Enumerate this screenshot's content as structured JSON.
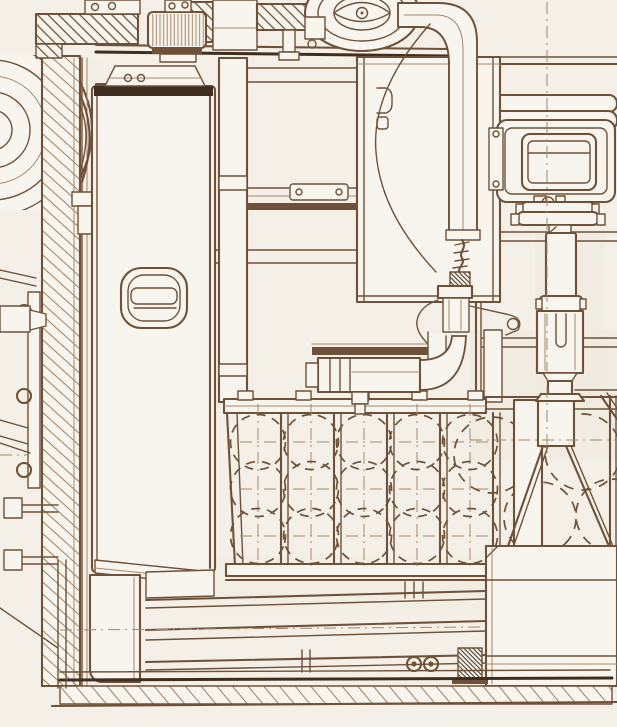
{
  "figure": {
    "kind": "technical-sectional-line-drawing",
    "subject": "vehicle interior cross-section, sepia ink on aged paper",
    "visible_text": "none"
  },
  "palette": {
    "paper": "#f4f0e7",
    "face": "#f8f5ee",
    "ink": "#6e5138",
    "ink_dark": "#3f2e1e",
    "ink_light": "#a4876a",
    "tint": "#e7e1d3"
  },
  "components": {
    "hull_wall": "hatched side armor wall",
    "roadwheel": "concentric wheel arcs at left edge",
    "knurled_gear": "ribbed cylinder on roof",
    "fan_housing": "concentric elliptical housing",
    "intake_pipe": "curved pipe elbow descending to valve",
    "oil_tank": "tall white tank with D-handle",
    "periscope_box": "rounded rectangular sight box",
    "telescopic_column": "stacked cylinder stand",
    "valve_assembly": "valve with elbow and flanged fitting",
    "ammo_rack": "frame with dashed round stores",
    "floor": "layered bars over hatched hull floor"
  },
  "rack": {
    "columns": 5,
    "rows": 3,
    "col_centers_x": [
      258,
      311,
      364,
      417,
      470
    ],
    "row_centers_y": [
      442,
      489,
      536
    ],
    "radius": 27.5,
    "post_offset": 26.5,
    "top_y": 413,
    "bottom_y": 564,
    "dash": "9 7"
  },
  "right_rack": {
    "circles": [
      [
        492,
        455,
        38
      ],
      [
        583,
        452,
        38
      ],
      [
        540,
        518,
        36
      ],
      [
        612,
        515,
        36
      ]
    ],
    "dash": "10 8"
  }
}
